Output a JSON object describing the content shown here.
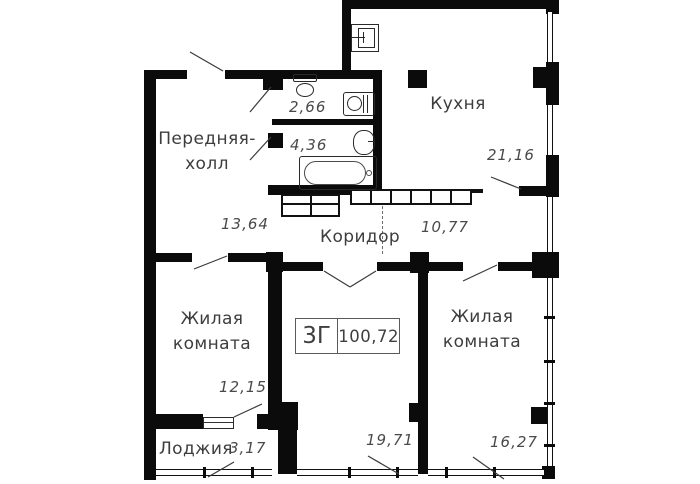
{
  "stamp": {
    "type": "3Г",
    "total_area": "100,72"
  },
  "rooms": {
    "hall": {
      "label": "Передняя-холл",
      "area": "13,64"
    },
    "wc": {
      "area": "2,66"
    },
    "bathroom": {
      "area": "4,36"
    },
    "kitchen": {
      "label": "Кухня",
      "area": "21,16"
    },
    "corridor": {
      "label": "Коридор",
      "area": "10,77"
    },
    "living_left": {
      "label": "Жилая комната",
      "area": "12,15"
    },
    "living_middle": {
      "area": "19,71"
    },
    "living_right": {
      "label": "Жилая комната",
      "area": "16,27"
    },
    "loggia": {
      "label": "Лоджия",
      "area": "3,17"
    }
  },
  "colors": {
    "wall": "#0b0b0b",
    "line": "#3a3a3a",
    "text": "#3d3d3d",
    "background": "#ffffff"
  },
  "icons": [
    "toilet-icon",
    "washing-machine-icon",
    "sink-icon",
    "bathtub-icon",
    "kitchen-sink-icon"
  ]
}
